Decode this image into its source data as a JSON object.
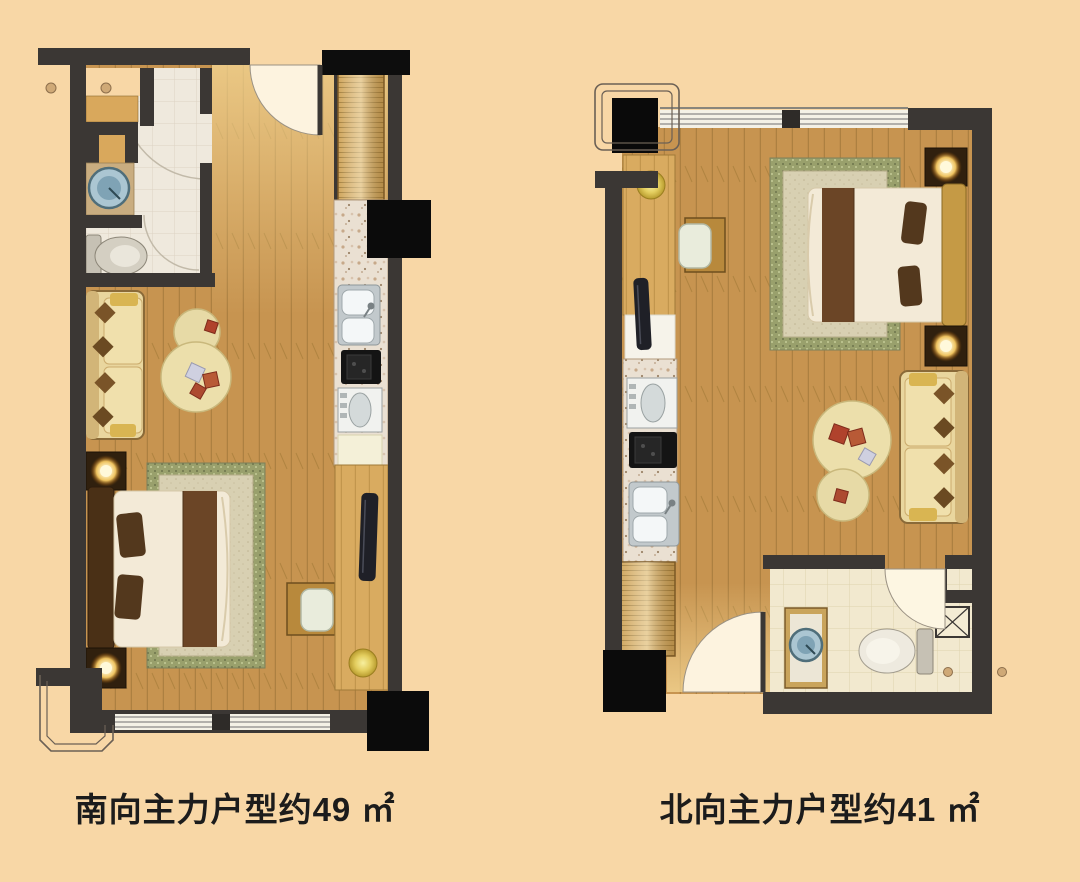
{
  "canvas": {
    "width": 1080,
    "height": 882,
    "background_color": "#f8d7a6"
  },
  "captions": {
    "south": "南向主力户型约49 ㎡",
    "north": "北向主力户型约41 ㎡"
  },
  "plans": [
    {
      "id": "south",
      "orientation_label": "南向",
      "type_label": "主力户型",
      "area_approx_sqm": 49,
      "rooms": [
        "entry",
        "bathroom",
        "kitchen-aisle",
        "living-sleeping-area",
        "south-window-bay"
      ],
      "furniture_icons": [
        "entry-door-swing-icon",
        "washing-machine-icon",
        "toilet-icon",
        "shower-door-arc-icon",
        "sofa-icon",
        "tea-table-icons",
        "double-bed-icon",
        "area-rug-icon",
        "nightstand-lamp-icons",
        "wardrobe-icon",
        "kitchen-counter-icon",
        "double-sink-icon",
        "cooktop-icon",
        "kitchen-appliance-icon",
        "cabinet-icon",
        "desk-icon",
        "tv-icon",
        "desk-chair-icon",
        "stool-icon",
        "window-icon",
        "balcony-outline-icon",
        "structural-column-icons",
        "dimension-dot-icons"
      ]
    },
    {
      "id": "north",
      "orientation_label": "北向",
      "type_label": "主力户型",
      "area_approx_sqm": 41,
      "rooms": [
        "entry",
        "bathroom",
        "kitchen-aisle",
        "living-sleeping-area",
        "north-window-bay"
      ],
      "furniture_icons": [
        "entry-door-swing-icon",
        "washing-machine-icon",
        "toilet-icon",
        "bathroom-door-arc-icon",
        "shower-shaft-x-icon",
        "sofa-icon",
        "tea-table-icons",
        "double-bed-icon",
        "area-rug-icon",
        "nightstand-lamp-icons",
        "wardrobe-icon",
        "kitchen-counter-icon",
        "double-sink-icon",
        "cooktop-icon",
        "kitchen-appliance-icon",
        "desk-icon",
        "tv-icon",
        "desk-chair-icon",
        "stool-icon",
        "window-icon",
        "balcony-outline-icon",
        "structural-column-icons",
        "dimension-dot-icons"
      ]
    }
  ],
  "palette": {
    "background": "#f8d7a6",
    "wall": "#3b3734",
    "column_black": "#0b0b0b",
    "wood_floor": "#c79450",
    "desk_wood": "#d9ab60",
    "bathroom_tile": "#efe9dd",
    "warm_tile": "#f2e9cf",
    "rug_border": "#99a06c",
    "rug_center": "#d8d0b2",
    "sofa_cream": "#ecd9a4",
    "gold_accent": "#d9b552",
    "bed_linen": "#f3ead7",
    "bed_runner": "#6b4526",
    "pillow_brown": "#4f3419",
    "headboard_gold": "#c59a45",
    "lamp_glow": "#f6dd8e",
    "washer_blue": "#8fb2c2",
    "window_gray": "#9b9b97",
    "caption_text": "#1c1c1c"
  }
}
